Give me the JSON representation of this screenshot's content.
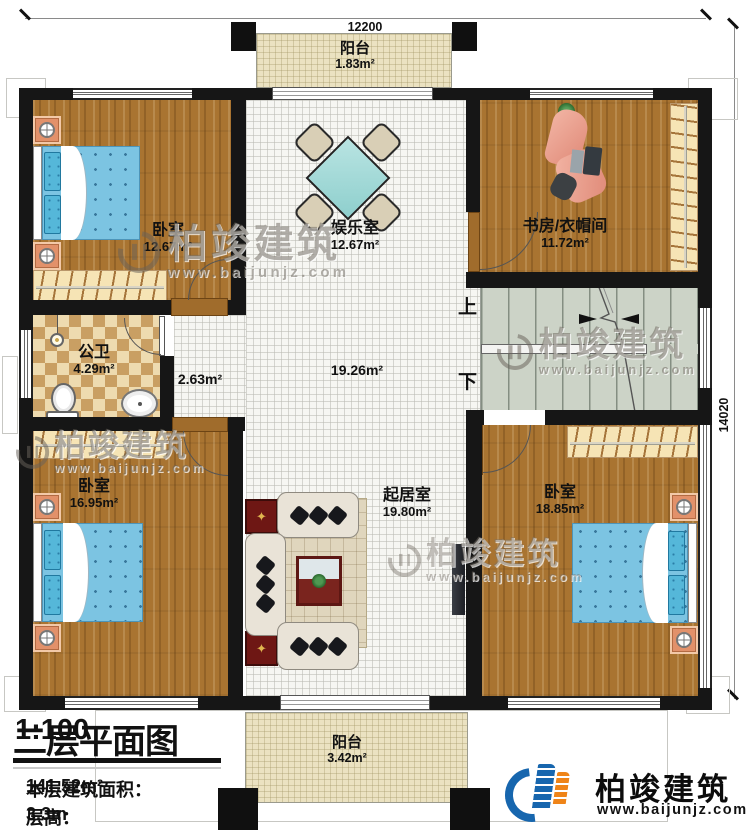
{
  "title_block": {
    "title": "二层平面图",
    "scale": "1:100",
    "area_label": "本层建筑面积：",
    "area_value": "141.52m²",
    "floor_height_label": "层高：",
    "floor_height_value": "3.3m"
  },
  "dimensions": {
    "width_mm": "12200",
    "height_mm": "14020"
  },
  "rooms": {
    "balcony_top": {
      "name": "阳台",
      "area": "1.83m²"
    },
    "bedroom_top_left": {
      "name": "卧室",
      "area": "12.67m²"
    },
    "entertainment": {
      "name": "娱乐室",
      "area": "12.67m²"
    },
    "study_cloak": {
      "name": "书房/衣帽间",
      "area": "11.72m²"
    },
    "bathroom": {
      "name": "公卫",
      "area": "4.29m²"
    },
    "corridor": {
      "area": "2.63m²"
    },
    "hall": {
      "area": "19.26m²"
    },
    "bedroom_bottom_left": {
      "name": "卧室",
      "area": "16.95m²"
    },
    "living": {
      "name": "起居室",
      "area": "19.80m²"
    },
    "bedroom_bottom_right": {
      "name": "卧室",
      "area": "18.85m²"
    },
    "balcony_bottom": {
      "name": "阳台",
      "area": "3.42m²"
    }
  },
  "stairs": {
    "up_label": "上",
    "down_label": "下"
  },
  "watermark": {
    "brand": "柏竣建筑",
    "url": "www.baijunjz.com"
  },
  "logo": {
    "brand": "柏竣建筑",
    "url": "www.baijunjz.com"
  },
  "colors": {
    "wall": "#161616",
    "wood": "#a97431",
    "tile": "#f6f6f2",
    "checker": "#c99f63",
    "balcony": "#ebe2c1",
    "stair": "#ccd3c7",
    "bed_blue": "#7cc4e2",
    "logo_blue": "#1766ae",
    "logo_orange": "#ef8418"
  }
}
